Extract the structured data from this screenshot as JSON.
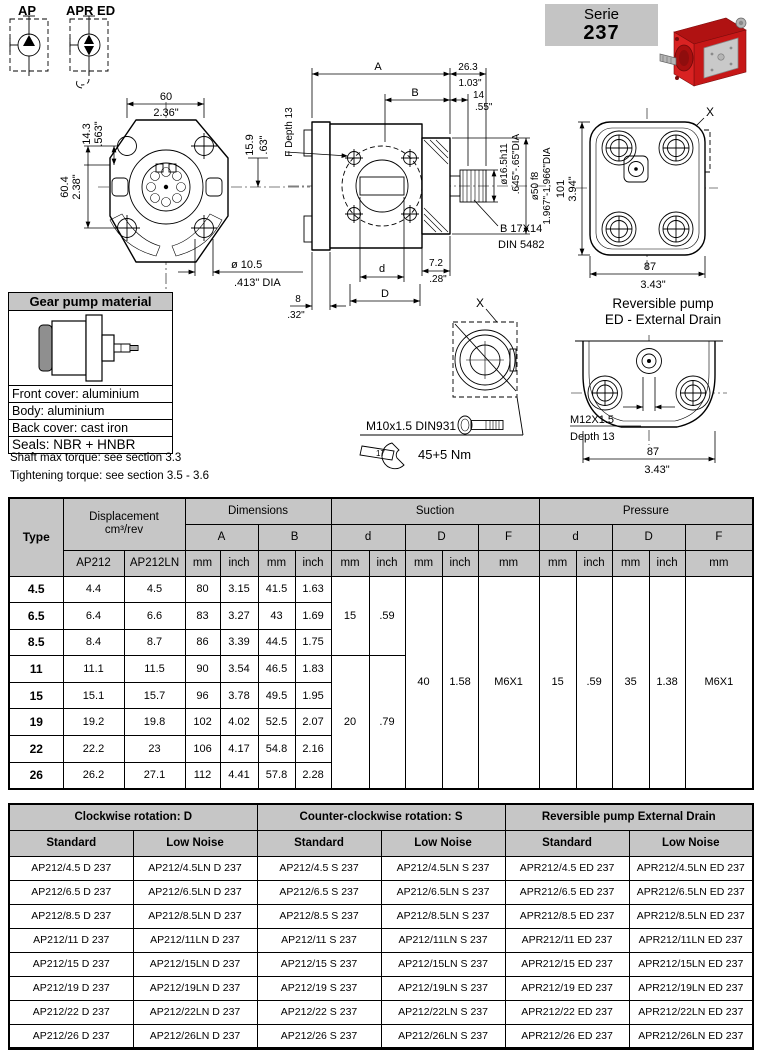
{
  "badge": {
    "label": "Serie",
    "number": "237"
  },
  "symbols": {
    "ap": "AP",
    "apr_ed": "APR ED"
  },
  "front_view": {
    "w_mm": "60",
    "w_in": "2.36\"",
    "offset_mm": "14.3",
    "offset_in": ".563\"",
    "h_mm": "60.4",
    "h_in": "2.38\"",
    "side_mm": "15.9",
    "side_in": ".63\"",
    "hole_mm": "ø 10.5",
    "hole_in": ".413\"  DIA"
  },
  "side_view": {
    "a": "A",
    "b": "B",
    "len_mm": "26.3",
    "len_in": "1.03\"",
    "tip_mm": "14",
    "tip_in": ".55\"",
    "f_depth": "F Depth 13",
    "shaft_dia": "ø16.5h11",
    "shaft_dia_in": ".645\"-.65\"DIA",
    "pilot_dia": "ø50 f8",
    "pilot_dia_in": "1.967\"-1.966\"DIA",
    "spline": "B 17X14",
    "spline_std": "DIN 5482",
    "d": "d",
    "gap_mm": "7.2",
    "gap_in": ".28\"",
    "off_mm": "8",
    "off_in": ".32\"",
    "big_d": "D"
  },
  "back_view": {
    "h_mm": "101",
    "h_in": "3.94\"",
    "w_mm": "87",
    "w_in": "3.43\"",
    "x": "X"
  },
  "detail_x": {
    "x": "X",
    "bolt": "M10x1.5 DIN931",
    "wrench": "17",
    "torque": "45+5 Nm"
  },
  "reversible": {
    "title1": "Reversible pump",
    "title2": "ED - External Drain",
    "thread": "M12X1.5",
    "depth": "Depth 13",
    "w_mm": "87",
    "w_in": "3.43\""
  },
  "material": {
    "title": "Gear pump material",
    "rows": [
      "Front cover: aluminium",
      "Body: aluminium",
      "Back cover: cast iron",
      "Seals: NBR + HNBR"
    ]
  },
  "notes": {
    "torque": "Shaft max torque: see section 3.3",
    "tightening": "Tightening torque: see section 3.5 - 3.6"
  },
  "main_table": {
    "h_type": "Type",
    "h_displacement": "Displacement",
    "h_displacement_unit": "cm³/rev",
    "h_dimensions": "Dimensions",
    "h_suction": "Suction",
    "h_pressure": "Pressure",
    "h_ap212": "AP212",
    "h_ap212ln": "AP212LN",
    "h_a": "A",
    "h_b": "B",
    "h_d": "d",
    "h_big_d": "D",
    "h_f": "F",
    "u_mm": "mm",
    "u_inch": "inch",
    "rows": [
      {
        "type": "4.5",
        "ap212": "4.4",
        "ap212ln": "4.5",
        "a_mm": "80",
        "a_in": "3.15",
        "b_mm": "41.5",
        "b_in": "1.63"
      },
      {
        "type": "6.5",
        "ap212": "6.4",
        "ap212ln": "6.6",
        "a_mm": "83",
        "a_in": "3.27",
        "b_mm": "43",
        "b_in": "1.69"
      },
      {
        "type": "8.5",
        "ap212": "8.4",
        "ap212ln": "8.7",
        "a_mm": "86",
        "a_in": "3.39",
        "b_mm": "44.5",
        "b_in": "1.75"
      },
      {
        "type": "11",
        "ap212": "11.1",
        "ap212ln": "11.5",
        "a_mm": "90",
        "a_in": "3.54",
        "b_mm": "46.5",
        "b_in": "1.83"
      },
      {
        "type": "15",
        "ap212": "15.1",
        "ap212ln": "15.7",
        "a_mm": "96",
        "a_in": "3.78",
        "b_mm": "49.5",
        "b_in": "1.95"
      },
      {
        "type": "19",
        "ap212": "19.2",
        "ap212ln": "19.8",
        "a_mm": "102",
        "a_in": "4.02",
        "b_mm": "52.5",
        "b_in": "2.07"
      },
      {
        "type": "22",
        "ap212": "22.2",
        "ap212ln": "23",
        "a_mm": "106",
        "a_in": "4.17",
        "b_mm": "54.8",
        "b_in": "2.16"
      },
      {
        "type": "26",
        "ap212": "26.2",
        "ap212ln": "27.1",
        "a_mm": "112",
        "a_in": "4.41",
        "b_mm": "57.8",
        "b_in": "2.28"
      }
    ],
    "suction_d_small": {
      "mm": "15",
      "inch": ".59"
    },
    "suction_d_large": {
      "mm": "20",
      "inch": ".79"
    },
    "suction_big_d": {
      "mm": "40",
      "inch": "1.58"
    },
    "suction_f": "M6X1",
    "pressure_d": {
      "mm": "15",
      "inch": ".59"
    },
    "pressure_big_d": {
      "mm": "35",
      "inch": "1.38"
    },
    "pressure_f": "M6X1"
  },
  "order_table": {
    "g_cw": "Clockwise rotation: D",
    "g_ccw": "Counter-clockwise rotation: S",
    "g_rev": "Reversible pump External Drain",
    "h_standard": "Standard",
    "h_low_noise": "Low Noise",
    "rows": [
      [
        "AP212/4.5 D 237",
        "AP212/4.5LN D 237",
        "AP212/4.5 S 237",
        "AP212/4.5LN S 237",
        "APR212/4.5 ED 237",
        "APR212/4.5LN ED 237"
      ],
      [
        "AP212/6.5 D 237",
        "AP212/6.5LN D 237",
        "AP212/6.5 S 237",
        "AP212/6.5LN S 237",
        "APR212/6.5 ED 237",
        "APR212/6.5LN ED 237"
      ],
      [
        "AP212/8.5 D 237",
        "AP212/8.5LN D 237",
        "AP212/8.5 S 237",
        "AP212/8.5LN S 237",
        "APR212/8.5 ED 237",
        "APR212/8.5LN ED 237"
      ],
      [
        "AP212/11 D 237",
        "AP212/11LN D 237",
        "AP212/11 S 237",
        "AP212/11LN S 237",
        "APR212/11 ED 237",
        "APR212/11LN ED 237"
      ],
      [
        "AP212/15 D 237",
        "AP212/15LN D 237",
        "AP212/15 S 237",
        "AP212/15LN S 237",
        "APR212/15 ED 237",
        "APR212/15LN ED 237"
      ],
      [
        "AP212/19 D 237",
        "AP212/19LN D 237",
        "AP212/19 S 237",
        "AP212/19LN S 237",
        "APR212/19 ED 237",
        "APR212/19LN ED 237"
      ],
      [
        "AP212/22 D 237",
        "AP212/22LN D 237",
        "AP212/22 S 237",
        "AP212/22LN S 237",
        "APR212/22 ED 237",
        "APR212/22LN ED 237"
      ],
      [
        "AP212/26 D 237",
        "AP212/26LN D 237",
        "AP212/26 S 237",
        "AP212/26LN S 237",
        "APR212/26 ED 237",
        "APR212/26LN ED 237"
      ]
    ]
  }
}
